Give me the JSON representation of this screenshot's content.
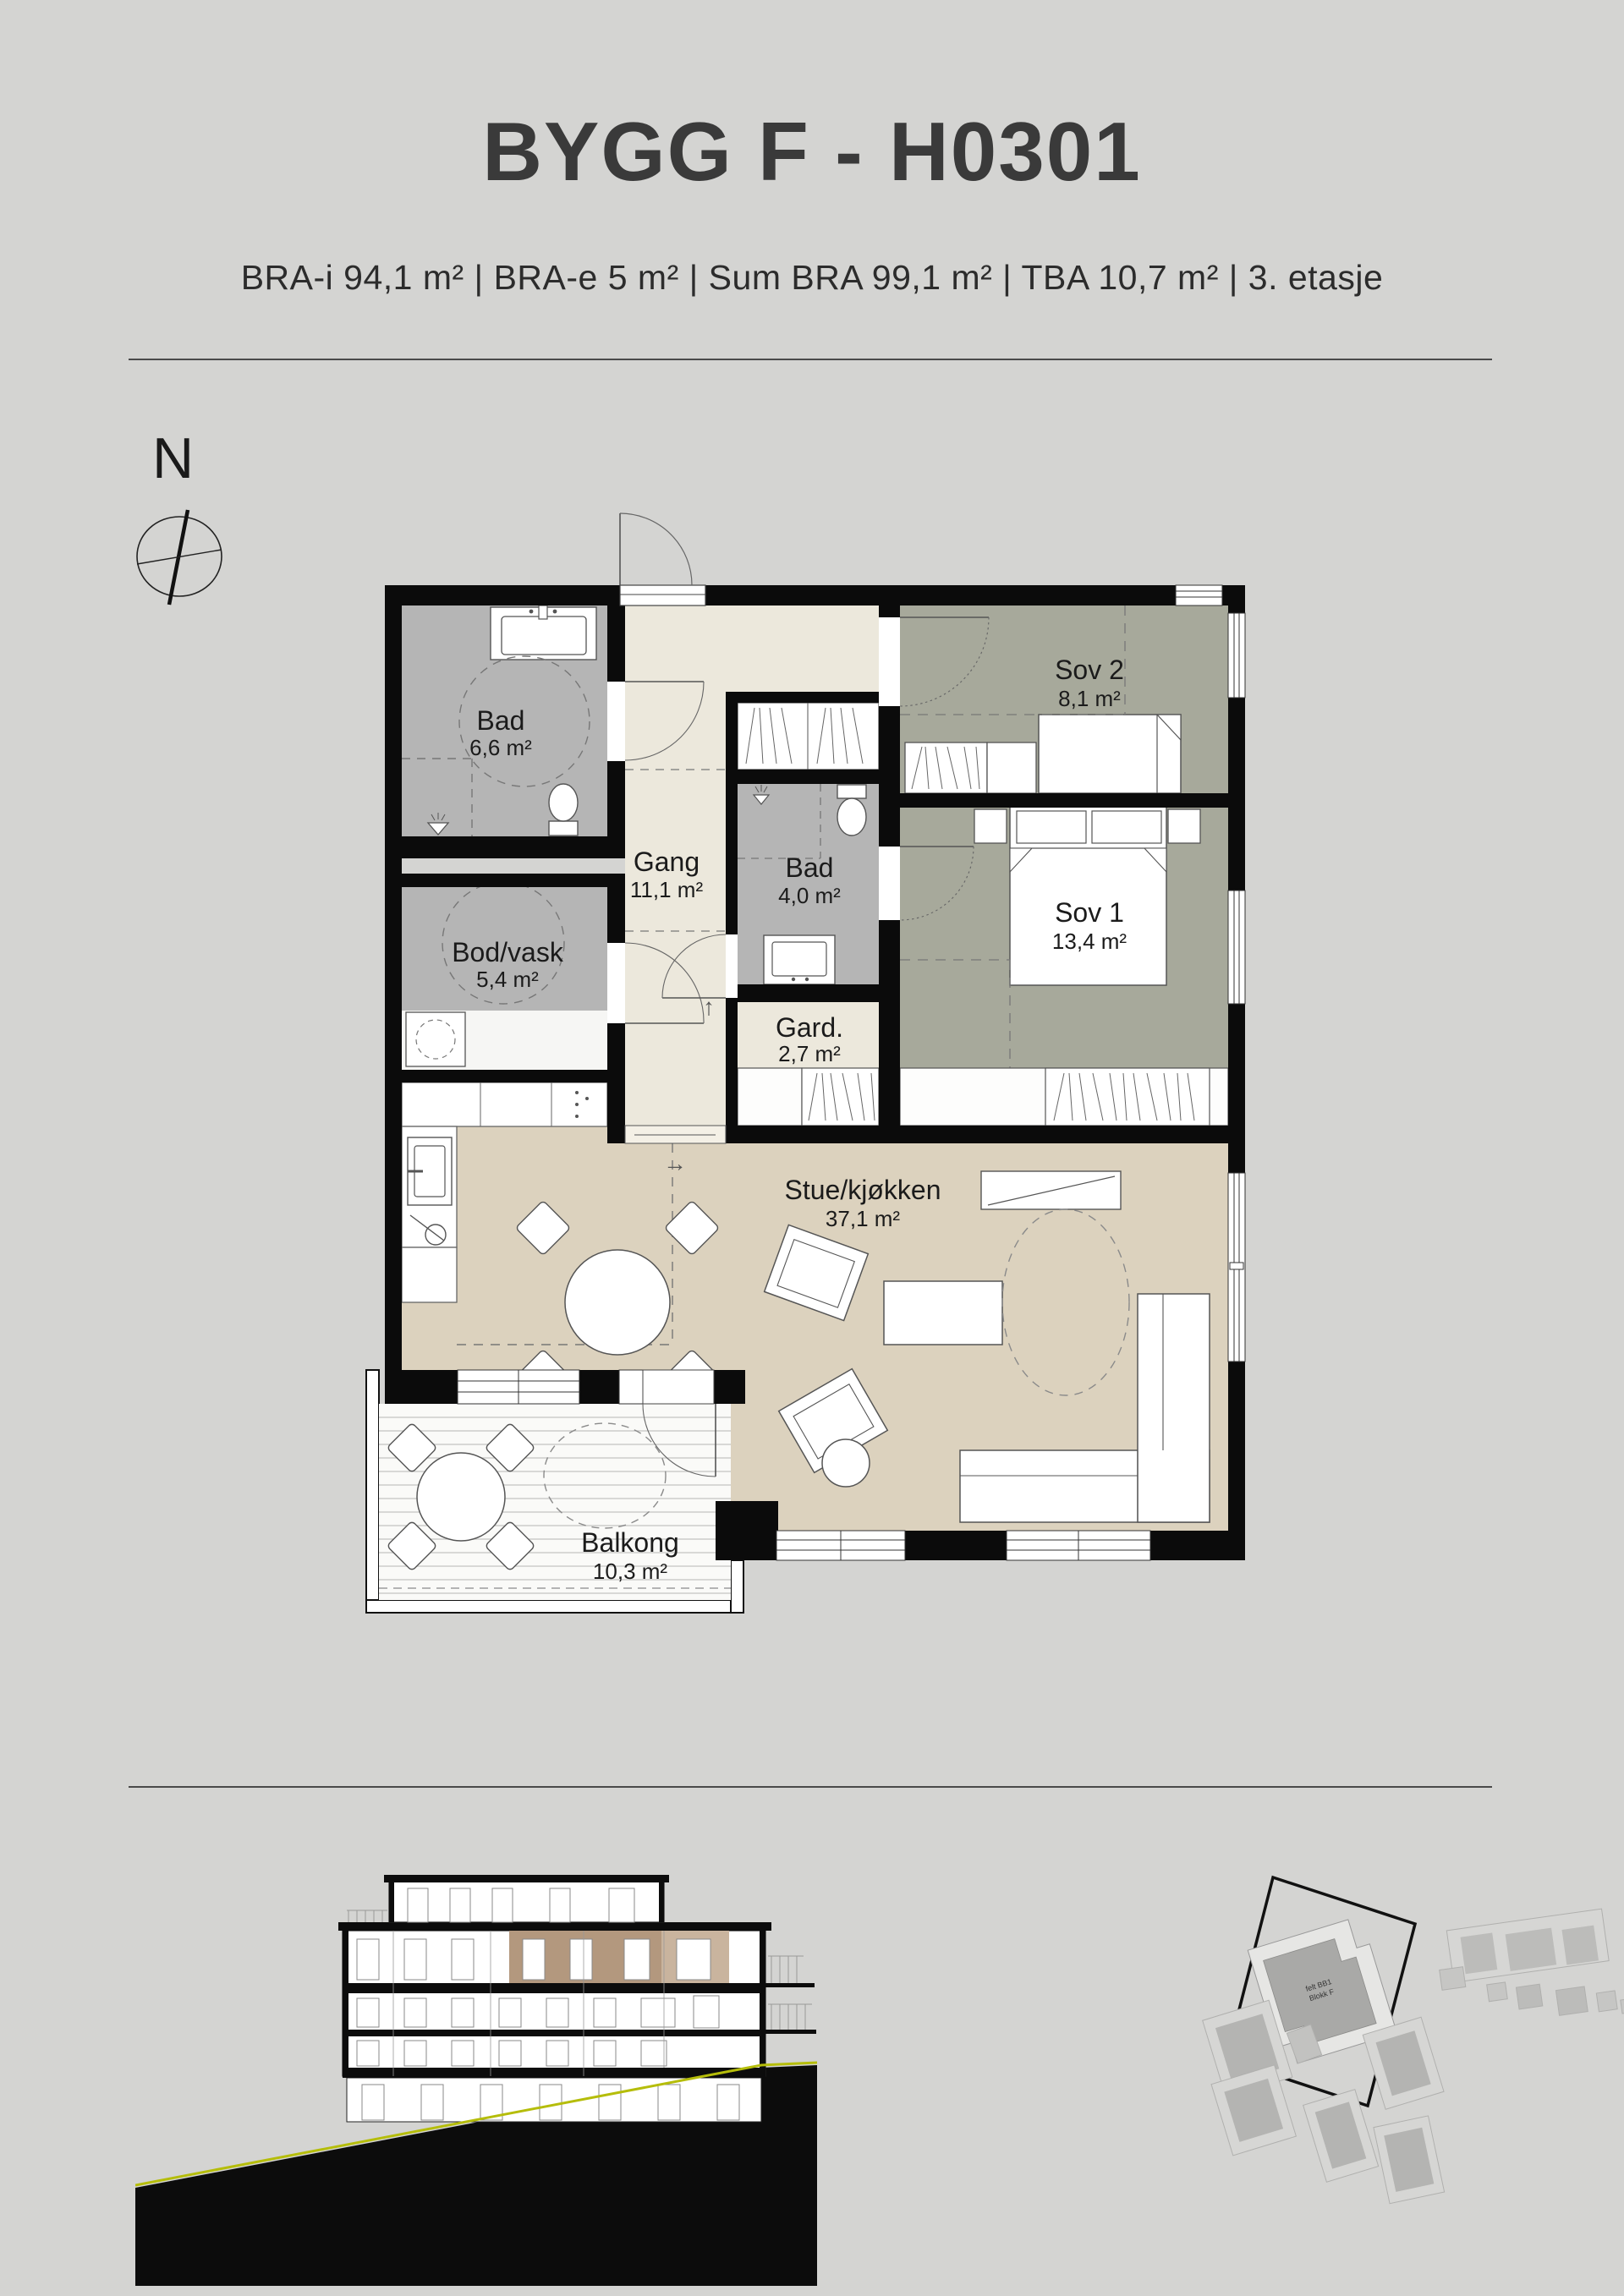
{
  "header": {
    "title": "BYGG F - H0301",
    "subtitle": "BRA-i 94,1 m²  |  BRA-e 5 m²  |  Sum BRA 99,1 m²  |  TBA 10,7 m² |  3. etasje"
  },
  "compass": {
    "north_label": "N"
  },
  "plan": {
    "rooms": {
      "bad1": {
        "name": "Bad",
        "area": "6,6 m²"
      },
      "bodvask": {
        "name": "Bod/vask",
        "area": "5,4 m²"
      },
      "gang": {
        "name": "Gang",
        "area": "11,1 m²"
      },
      "bad2": {
        "name": "Bad",
        "area": "4,0 m²"
      },
      "gard": {
        "name": "Gard.",
        "area": "2,7 m²"
      },
      "sov2": {
        "name": "Sov 2",
        "area": "8,1 m²"
      },
      "sov1": {
        "name": "Sov 1",
        "area": "13,4 m²"
      },
      "stue": {
        "name": "Stue/kjøkken",
        "area": "37,1 m²"
      },
      "balkong": {
        "name": "Balkong",
        "area": "10,3 m²"
      }
    },
    "arrows": {
      "up": "↑",
      "right": "→"
    }
  },
  "site": {
    "highlight": {
      "line1": "felt BB1",
      "line2": "Blokk F"
    }
  },
  "colors": {
    "background": "#d4d4d2",
    "wall": "#0b0b0b",
    "floor_bath": "#b5b5b5",
    "floor_hall": "#ece8dc",
    "floor_bedroom": "#a7a99b",
    "floor_living": "#dcd2be",
    "balcony_deck": "#fafaf8",
    "section_highlight": "#b3987e",
    "section_highlight_light": "#c9b49e",
    "terrain_line": "#b5bd0a"
  }
}
